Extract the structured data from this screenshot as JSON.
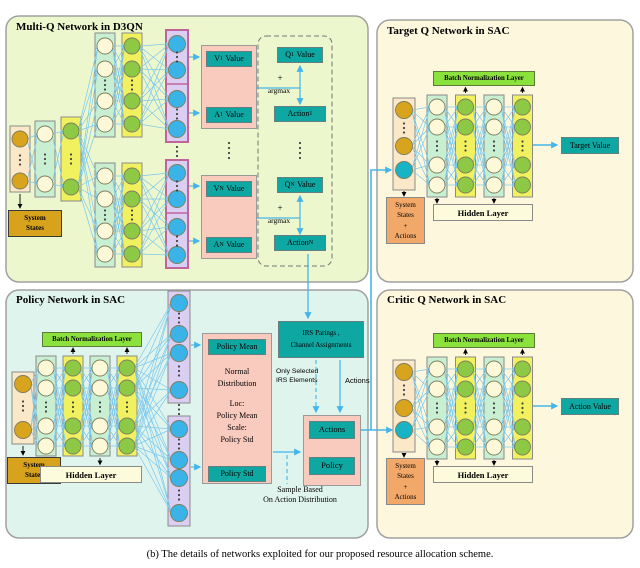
{
  "caption": "(b) The details of networks exploited for our proposed resource allocation scheme.",
  "colors": {
    "teal_box": "#0ea7a2",
    "batch_norm_green": "#8ce23c",
    "arrow_blue": "#44b5ea",
    "panel_multiq_bg": "#edf7cd",
    "panel_sac_bg": "#fdf8dd",
    "panel_policy_bg": "#e0f4ee"
  },
  "multiq": {
    "title": "Multi-Q Network in D3QN",
    "system_states": [
      "System",
      "States"
    ],
    "groups": [
      {
        "sub": "1",
        "v": "V",
        "a": "A",
        "q": "Q",
        "action": "Action",
        "value": "Value",
        "plus": "+",
        "argmax": "argmax"
      },
      {
        "sub": "N",
        "v": "V",
        "a": "A",
        "q": "Q",
        "action": "Action",
        "value": "Value",
        "plus": "+",
        "argmax": "argmax"
      }
    ]
  },
  "target": {
    "title": "Target Q Network in SAC",
    "batch_norm": "Batch Normalization Layer",
    "hidden_layer": "Hidden Layer",
    "input_label": [
      "System",
      "States",
      "+",
      "Actions"
    ],
    "output": "Target Value"
  },
  "policy": {
    "title": "Policy Network in SAC",
    "batch_norm": "Batch Normalization Layer",
    "hidden_layer": "Hidden Layer",
    "system_states": [
      "System",
      "States"
    ],
    "policy_mean": "Policy Mean",
    "policy_std": "Policy Std",
    "distribution": [
      "Normal",
      "Distribution",
      "Loc:",
      "Policy Mean",
      "Scale:",
      "Policy Std"
    ],
    "irs_box": [
      "IRS Parings ,",
      "Channel Assignments"
    ],
    "only_selected": [
      "Only Selected",
      "IRS Elements"
    ],
    "actions_arrow_label": "Actions",
    "actions_box": "Actions",
    "policy_box": "Policy",
    "sample_note": [
      "Sample Based",
      "On Action Distribution"
    ]
  },
  "critic": {
    "title": "Critic Q Network in SAC",
    "batch_norm": "Batch Normalization Layer",
    "hidden_layer": "Hidden Layer",
    "input_label": [
      "System",
      "States",
      "+",
      "Actions"
    ],
    "output": "Action Value"
  }
}
